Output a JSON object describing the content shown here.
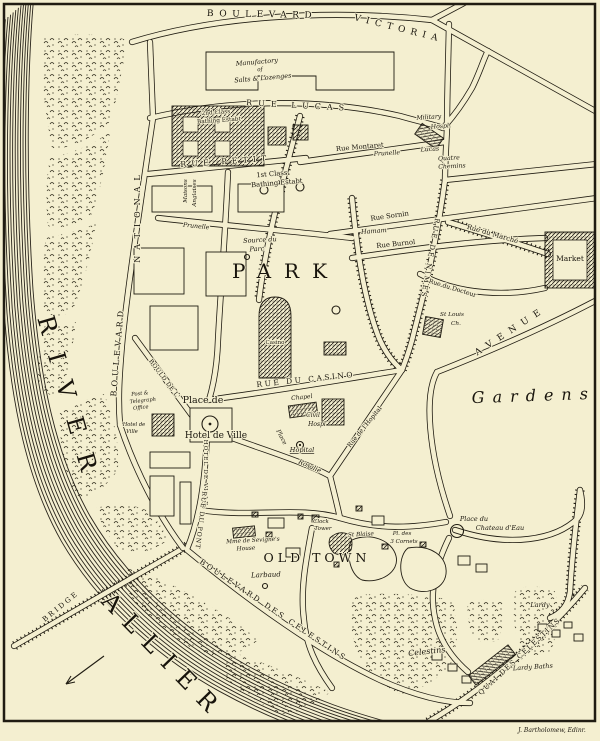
{
  "map": {
    "colors": {
      "paper": "#f4efd0",
      "ink": "#201c12"
    },
    "signature": "J. Bartholomew, Edinr.",
    "labels": [
      {
        "id": "boulevard",
        "t": "BOULEVARD",
        "x": 262,
        "y": 17,
        "s": 9,
        "r": 1,
        "sp": 5.5
      },
      {
        "id": "victoria",
        "t": "VICTORIA",
        "x": 398,
        "y": 31,
        "s": 9,
        "r": 14,
        "sp": 5.5
      },
      {
        "id": "manufactory-1",
        "t": "Manufactory",
        "x": 257,
        "y": 64,
        "s": 6.5,
        "r": -5,
        "i": 1
      },
      {
        "id": "manufactory-2",
        "t": "of",
        "x": 260,
        "y": 71,
        "s": 5.5,
        "r": -5,
        "i": 1
      },
      {
        "id": "manufactory-3",
        "t": "Salts & Lozenges",
        "x": 263,
        "y": 80,
        "s": 6.5,
        "r": -5,
        "i": 1
      },
      {
        "id": "rue-lucas",
        "t": "RUE LUCAS",
        "x": 298,
        "y": 108,
        "s": 8,
        "r": 3,
        "sp": 6
      },
      {
        "id": "military-hosp-1",
        "t": "Military",
        "x": 429,
        "y": 119,
        "s": 6.2,
        "r": -4,
        "i": 1
      },
      {
        "id": "military-hosp-2",
        "t": "Hospl.",
        "x": 441,
        "y": 128,
        "s": 6.2,
        "r": -4,
        "i": 1
      },
      {
        "id": "rue-montaret",
        "t": "Rue Montaret",
        "x": 360,
        "y": 149,
        "s": 6.8,
        "r": -5
      },
      {
        "id": "prunelle-spring",
        "t": "Prunelle",
        "x": 387,
        "y": 155,
        "s": 6.2,
        "r": -3,
        "i": 1
      },
      {
        "id": "lucas-spring",
        "t": "Lucas",
        "x": 430,
        "y": 151,
        "s": 6.2,
        "r": -3,
        "i": 1
      },
      {
        "id": "quatre-chemins-1",
        "t": "Quatre",
        "x": 449,
        "y": 160,
        "s": 6.2,
        "r": -3,
        "i": 1
      },
      {
        "id": "quatre-chemins-2",
        "t": "Chemins",
        "x": 452,
        "y": 168,
        "s": 6.2,
        "r": -3,
        "i": 1
      },
      {
        "id": "second-class-1",
        "t": "2nd Class",
        "x": 216,
        "y": 114,
        "s": 5.8,
        "r": -4
      },
      {
        "id": "second-class-2",
        "t": "Bathing Estabt",
        "x": 219,
        "y": 122,
        "s": 5.8,
        "r": -4
      },
      {
        "id": "first-class-1",
        "t": "1st Class",
        "x": 272,
        "y": 176,
        "s": 6.8,
        "r": -5
      },
      {
        "id": "first-class-2",
        "t": "Bathing Estabt",
        "x": 277,
        "y": 185,
        "s": 6.8,
        "r": -5
      },
      {
        "id": "rue-petit",
        "t": "RUE PETIT",
        "x": 226,
        "y": 164,
        "s": 8,
        "r": -4,
        "sp": 5
      },
      {
        "id": "national",
        "t": "NATIONAL",
        "x": 140,
        "y": 216,
        "s": 8,
        "r": -90,
        "sp": 6
      },
      {
        "id": "boulevard-national",
        "t": "BOULEVARD",
        "x": 120,
        "y": 352,
        "s": 8,
        "r": -85,
        "sp": 4
      },
      {
        "id": "maisons",
        "t": "Maisons",
        "x": 187,
        "y": 191,
        "s": 5.6,
        "r": -90,
        "i": 1
      },
      {
        "id": "anglaises",
        "t": "Anglaises",
        "x": 196,
        "y": 193,
        "s": 5.6,
        "r": -90,
        "i": 1
      },
      {
        "id": "rue-prunelle",
        "t": "Prunelle",
        "x": 196,
        "y": 228,
        "s": 6.2,
        "r": 6,
        "i": 1
      },
      {
        "id": "source-du-parc-1",
        "t": "Source du",
        "x": 260,
        "y": 242,
        "s": 6.5,
        "r": -3,
        "i": 1
      },
      {
        "id": "source-du-parc-2",
        "t": "Parc",
        "x": 257,
        "y": 251,
        "s": 6.5,
        "r": -3,
        "i": 1
      },
      {
        "id": "park",
        "t": "PARK",
        "x": 286,
        "y": 278,
        "s": 20,
        "sp": 13
      },
      {
        "id": "casino",
        "t": "Casino",
        "x": 275,
        "y": 344,
        "s": 5.5
      },
      {
        "id": "rue-du-casino",
        "t": "RUE DU CASINO",
        "x": 306,
        "y": 382,
        "s": 7.5,
        "r": -6,
        "sp": 2.5
      },
      {
        "id": "place-de",
        "t": "Place de",
        "x": 203,
        "y": 403,
        "s": 9.5
      },
      {
        "id": "hotel-de-ville",
        "t": "Hotel de Ville",
        "x": 216,
        "y": 438,
        "s": 9
      },
      {
        "id": "hotel-de-ville-sm-1",
        "t": "Hotel de",
        "x": 134,
        "y": 426,
        "s": 5.2,
        "i": 1
      },
      {
        "id": "hotel-de-ville-sm-2",
        "t": "Ville",
        "x": 132,
        "y": 433,
        "s": 5.2,
        "i": 1
      },
      {
        "id": "post-office-1",
        "t": "Post &",
        "x": 140,
        "y": 395,
        "s": 5.2,
        "r": -6,
        "i": 1
      },
      {
        "id": "post-office-2",
        "t": "Telegraph",
        "x": 143,
        "y": 402,
        "s": 5.2,
        "r": -6,
        "i": 1
      },
      {
        "id": "post-office-3",
        "t": "Office",
        "x": 141,
        "y": 409,
        "s": 5.2,
        "r": -6,
        "i": 1
      },
      {
        "id": "bould-de-l",
        "t": "BOULD DE L'",
        "x": 163,
        "y": 380,
        "s": 6,
        "r": 53,
        "sp": 0.5
      },
      {
        "id": "hotel-de-ville-street",
        "t": "HOTEL DE VILLE",
        "x": 204,
        "y": 473,
        "s": 5.8,
        "r": 90,
        "sp": 1
      },
      {
        "id": "rue-du-pont",
        "t": "RUE DU PONT",
        "x": 199,
        "y": 520,
        "s": 6.2,
        "r": 97,
        "sp": 1
      },
      {
        "id": "chapel",
        "t": "Chapel",
        "x": 302,
        "y": 399,
        "s": 6,
        "r": -6,
        "i": 1
      },
      {
        "id": "civil-hosp-1",
        "t": "Civil",
        "x": 313,
        "y": 417,
        "s": 6,
        "i": 1
      },
      {
        "id": "civil-hosp-2",
        "t": "Hospl",
        "x": 317,
        "y": 426,
        "s": 6,
        "i": 1
      },
      {
        "id": "place-hopital",
        "t": "Place",
        "x": 280,
        "y": 438,
        "s": 6,
        "r": 62,
        "i": 1
      },
      {
        "id": "hopital",
        "t": "Hopital",
        "x": 302,
        "y": 452,
        "s": 6.5,
        "i": 1,
        "u": 1
      },
      {
        "id": "rosalie",
        "t": "Rosalie",
        "x": 309,
        "y": 468,
        "s": 6.5,
        "r": 24,
        "i": 1
      },
      {
        "id": "rue-de-l-hopital",
        "t": "Rue de l'Hopital",
        "x": 366,
        "y": 428,
        "s": 6.2,
        "r": -51
      },
      {
        "id": "rue-sornin",
        "t": "Rue Sornin",
        "x": 390,
        "y": 218,
        "s": 6.8,
        "r": -8
      },
      {
        "id": "hamam",
        "t": "Hamam",
        "x": 374,
        "y": 233,
        "s": 6.5,
        "r": -4,
        "i": 1
      },
      {
        "id": "rue-burnol",
        "t": "Rue Burnol",
        "x": 396,
        "y": 246,
        "s": 6.8,
        "r": -6
      },
      {
        "id": "rue-du-marche",
        "t": "Rue du Marché",
        "x": 492,
        "y": 236,
        "s": 6.8,
        "r": 16
      },
      {
        "id": "market",
        "t": "Market",
        "x": 570,
        "y": 261,
        "s": 7.5
      },
      {
        "id": "rue-de-nimes",
        "t": "RUE DE NIMES",
        "x": 428,
        "y": 258,
        "s": 7,
        "r": 100,
        "sp": 2
      },
      {
        "id": "avenue",
        "t": "AVENUE",
        "x": 512,
        "y": 333,
        "s": 9,
        "r": -33,
        "sp": 7
      },
      {
        "id": "rue-du-docteur",
        "t": "Rue du Docteur",
        "x": 452,
        "y": 290,
        "s": 6.2,
        "r": 17
      },
      {
        "id": "st-louis-1",
        "t": "St Louis",
        "x": 452,
        "y": 316,
        "s": 5.8,
        "i": 1
      },
      {
        "id": "st-louis-2",
        "t": "Ch.",
        "x": 456,
        "y": 325,
        "s": 5.8,
        "i": 1
      },
      {
        "id": "gardens",
        "t": "Gardens",
        "x": 534,
        "y": 401,
        "s": 16,
        "r": -2,
        "sp": 8,
        "i": 1
      },
      {
        "id": "old-town",
        "t": "OLD TOWN",
        "x": 317,
        "y": 562,
        "s": 12.5,
        "sp": 4
      },
      {
        "id": "sevigne-1",
        "t": "Mme de Sevigne's",
        "x": 253,
        "y": 542,
        "s": 5.8,
        "r": -3,
        "i": 1
      },
      {
        "id": "sevigne-2",
        "t": "House",
        "x": 246,
        "y": 550,
        "s": 5.8,
        "r": -3,
        "i": 1
      },
      {
        "id": "clock-tower-1",
        "t": "Clock",
        "x": 321,
        "y": 523,
        "s": 5.5,
        "i": 1
      },
      {
        "id": "clock-tower-2",
        "t": "Tower",
        "x": 323,
        "y": 530,
        "s": 5.5,
        "i": 1
      },
      {
        "id": "st-blaise",
        "t": "St Blaise",
        "x": 361,
        "y": 536,
        "s": 5.8,
        "r": -3,
        "i": 1
      },
      {
        "id": "cornets-1",
        "t": "Pl. des",
        "x": 402,
        "y": 535,
        "s": 5.5,
        "i": 1
      },
      {
        "id": "cornets-2",
        "t": "3 Cornets",
        "x": 404,
        "y": 543,
        "s": 5.5,
        "i": 1
      },
      {
        "id": "chateau-deau-1",
        "t": "Place du",
        "x": 474,
        "y": 521,
        "s": 6.5,
        "i": 1
      },
      {
        "id": "chateau-deau-2",
        "t": "Chateau d'Eau",
        "x": 500,
        "y": 530,
        "s": 6.5,
        "i": 1
      },
      {
        "id": "larbaud",
        "t": "Larbaud",
        "x": 266,
        "y": 577,
        "s": 7,
        "r": -2,
        "i": 1
      },
      {
        "id": "blvd-des-celestins",
        "t": "BOULEVARD DES CELESTINS",
        "x": 272,
        "y": 612,
        "s": 7.5,
        "r": 34,
        "sp": 2.5
      },
      {
        "id": "celestins",
        "t": "Celestins",
        "x": 427,
        "y": 654,
        "s": 8,
        "r": -6,
        "i": 1
      },
      {
        "id": "quai-des-celestins",
        "t": "QUAI DES CELESTINS",
        "x": 521,
        "y": 658,
        "s": 7,
        "r": -43,
        "sp": 1.5
      },
      {
        "id": "lardy",
        "t": "Lardy",
        "x": 540,
        "y": 607,
        "s": 6.5,
        "i": 1
      },
      {
        "id": "lardy-baths",
        "t": "Lardy Baths",
        "x": 533,
        "y": 669,
        "s": 6.5,
        "r": -4,
        "i": 1
      },
      {
        "id": "river",
        "t": "RIVER",
        "x": 62,
        "y": 405,
        "s": 24,
        "r": 74,
        "sp": 20
      },
      {
        "id": "allier",
        "t": "ALLIER",
        "x": 158,
        "y": 662,
        "s": 24,
        "r": 46,
        "sp": 12
      },
      {
        "id": "bridge",
        "t": "BRIDGE",
        "x": 62,
        "y": 608,
        "s": 7,
        "r": -39,
        "sp": 2.5
      },
      {
        "id": "signature",
        "t": "J. Bartholomew, Edinr.",
        "x": 552,
        "y": 732,
        "s": 6,
        "i": 1
      }
    ]
  }
}
